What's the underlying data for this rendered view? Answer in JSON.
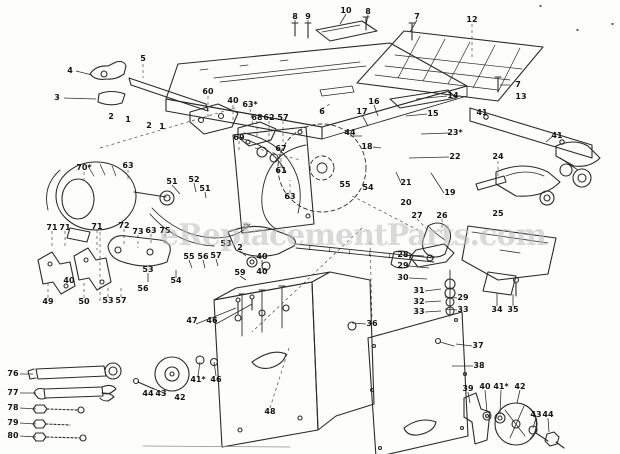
{
  "page": {
    "background": "#fdfdfc",
    "ink": "#2a2a2a"
  },
  "watermark": {
    "text": "eReplacementParts.com",
    "color": "#bdbdbd"
  },
  "diagram": {
    "description": "Exploded-view parts diagram of a bench table saw: table top, extension tables, rip fence rail, saw blade, motor, mounting brackets, switch assembly, cabinet base, stand panel, blower housing and hardware, with numbered part callouts.",
    "labels": [
      {
        "t": "4",
        "x": 70,
        "y": 71
      },
      {
        "t": "3",
        "x": 57,
        "y": 98
      },
      {
        "t": "5",
        "x": 143,
        "y": 59
      },
      {
        "t": "2",
        "x": 111,
        "y": 117
      },
      {
        "t": "1",
        "x": 128,
        "y": 120
      },
      {
        "t": "2",
        "x": 149,
        "y": 126
      },
      {
        "t": "1",
        "x": 162,
        "y": 127
      },
      {
        "t": "8",
        "x": 295,
        "y": 17
      },
      {
        "t": "9",
        "x": 308,
        "y": 17
      },
      {
        "t": "10",
        "x": 346,
        "y": 11
      },
      {
        "t": "8",
        "x": 368,
        "y": 12
      },
      {
        "t": "7",
        "x": 417,
        "y": 17
      },
      {
        "t": "12",
        "x": 472,
        "y": 20
      },
      {
        "t": "7",
        "x": 518,
        "y": 85
      },
      {
        "t": "13",
        "x": 521,
        "y": 97
      },
      {
        "t": "6",
        "x": 322,
        "y": 112
      },
      {
        "t": "17",
        "x": 362,
        "y": 112
      },
      {
        "t": "16",
        "x": 374,
        "y": 102
      },
      {
        "t": "60",
        "x": 208,
        "y": 92
      },
      {
        "t": "40",
        "x": 233,
        "y": 101
      },
      {
        "t": "63*",
        "x": 250,
        "y": 105
      },
      {
        "t": "68",
        "x": 257,
        "y": 118
      },
      {
        "t": "62",
        "x": 269,
        "y": 118
      },
      {
        "t": "57",
        "x": 283,
        "y": 118
      },
      {
        "t": "69",
        "x": 239,
        "y": 138
      },
      {
        "t": "67",
        "x": 281,
        "y": 149
      },
      {
        "t": "61",
        "x": 281,
        "y": 171
      },
      {
        "t": "63",
        "x": 290,
        "y": 197
      },
      {
        "t": "70*",
        "x": 84,
        "y": 168
      },
      {
        "t": "63",
        "x": 128,
        "y": 166
      },
      {
        "t": "44",
        "x": 350,
        "y": 133
      },
      {
        "t": "18",
        "x": 367,
        "y": 147
      },
      {
        "t": "14",
        "x": 453,
        "y": 96
      },
      {
        "t": "15",
        "x": 433,
        "y": 114
      },
      {
        "t": "23*",
        "x": 455,
        "y": 133
      },
      {
        "t": "22",
        "x": 455,
        "y": 157
      },
      {
        "t": "21",
        "x": 406,
        "y": 183
      },
      {
        "t": "19",
        "x": 450,
        "y": 193
      },
      {
        "t": "20",
        "x": 406,
        "y": 203
      },
      {
        "t": "55",
        "x": 345,
        "y": 185
      },
      {
        "t": "54",
        "x": 368,
        "y": 188
      },
      {
        "t": "41",
        "x": 482,
        "y": 113
      },
      {
        "t": "41",
        "x": 557,
        "y": 136
      },
      {
        "t": "24",
        "x": 498,
        "y": 157
      },
      {
        "t": "25",
        "x": 498,
        "y": 214
      },
      {
        "t": "26",
        "x": 442,
        "y": 216
      },
      {
        "t": "27",
        "x": 417,
        "y": 216
      },
      {
        "t": "52",
        "x": 194,
        "y": 180
      },
      {
        "t": "51",
        "x": 172,
        "y": 182
      },
      {
        "t": "51",
        "x": 205,
        "y": 189
      },
      {
        "t": "71",
        "x": 52,
        "y": 228
      },
      {
        "t": "71",
        "x": 65,
        "y": 228
      },
      {
        "t": "71",
        "x": 97,
        "y": 227
      },
      {
        "t": "72",
        "x": 124,
        "y": 226
      },
      {
        "t": "73",
        "x": 138,
        "y": 232
      },
      {
        "t": "63",
        "x": 151,
        "y": 231
      },
      {
        "t": "75",
        "x": 165,
        "y": 231
      },
      {
        "t": "53",
        "x": 148,
        "y": 270
      },
      {
        "t": "55",
        "x": 189,
        "y": 257
      },
      {
        "t": "56",
        "x": 203,
        "y": 257
      },
      {
        "t": "57",
        "x": 216,
        "y": 256
      },
      {
        "t": "54",
        "x": 176,
        "y": 281
      },
      {
        "t": "56",
        "x": 143,
        "y": 289
      },
      {
        "t": "40",
        "x": 69,
        "y": 281
      },
      {
        "t": "49",
        "x": 48,
        "y": 302
      },
      {
        "t": "50",
        "x": 84,
        "y": 302
      },
      {
        "t": "53",
        "x": 108,
        "y": 301
      },
      {
        "t": "57",
        "x": 121,
        "y": 301
      },
      {
        "t": "53",
        "x": 226,
        "y": 244
      },
      {
        "t": "2",
        "x": 240,
        "y": 248
      },
      {
        "t": "40",
        "x": 262,
        "y": 257
      },
      {
        "t": "59",
        "x": 240,
        "y": 273
      },
      {
        "t": "40",
        "x": 262,
        "y": 272
      },
      {
        "t": "28",
        "x": 403,
        "y": 255
      },
      {
        "t": "29",
        "x": 403,
        "y": 266
      },
      {
        "t": "30",
        "x": 403,
        "y": 278
      },
      {
        "t": "31",
        "x": 419,
        "y": 291
      },
      {
        "t": "32",
        "x": 419,
        "y": 302
      },
      {
        "t": "33",
        "x": 419,
        "y": 312
      },
      {
        "t": "29",
        "x": 463,
        "y": 298
      },
      {
        "t": "33",
        "x": 463,
        "y": 310
      },
      {
        "t": "34",
        "x": 497,
        "y": 310
      },
      {
        "t": "35",
        "x": 513,
        "y": 310
      },
      {
        "t": "36",
        "x": 372,
        "y": 324
      },
      {
        "t": "37",
        "x": 478,
        "y": 346
      },
      {
        "t": "38",
        "x": 479,
        "y": 366
      },
      {
        "t": "39",
        "x": 468,
        "y": 389
      },
      {
        "t": "40",
        "x": 485,
        "y": 387
      },
      {
        "t": "41*",
        "x": 501,
        "y": 387
      },
      {
        "t": "42",
        "x": 520,
        "y": 387
      },
      {
        "t": "43",
        "x": 536,
        "y": 415
      },
      {
        "t": "44",
        "x": 548,
        "y": 415
      },
      {
        "t": "47",
        "x": 192,
        "y": 321
      },
      {
        "t": "46",
        "x": 212,
        "y": 321
      },
      {
        "t": "41*",
        "x": 198,
        "y": 380
      },
      {
        "t": "46",
        "x": 216,
        "y": 380
      },
      {
        "t": "44",
        "x": 148,
        "y": 394
      },
      {
        "t": "43",
        "x": 161,
        "y": 394
      },
      {
        "t": "42",
        "x": 180,
        "y": 398
      },
      {
        "t": "48",
        "x": 270,
        "y": 412
      },
      {
        "t": "76",
        "x": 13,
        "y": 374
      },
      {
        "t": "77",
        "x": 13,
        "y": 393
      },
      {
        "t": "78",
        "x": 13,
        "y": 408
      },
      {
        "t": "79",
        "x": 13,
        "y": 423
      },
      {
        "t": "80",
        "x": 13,
        "y": 436
      }
    ]
  }
}
